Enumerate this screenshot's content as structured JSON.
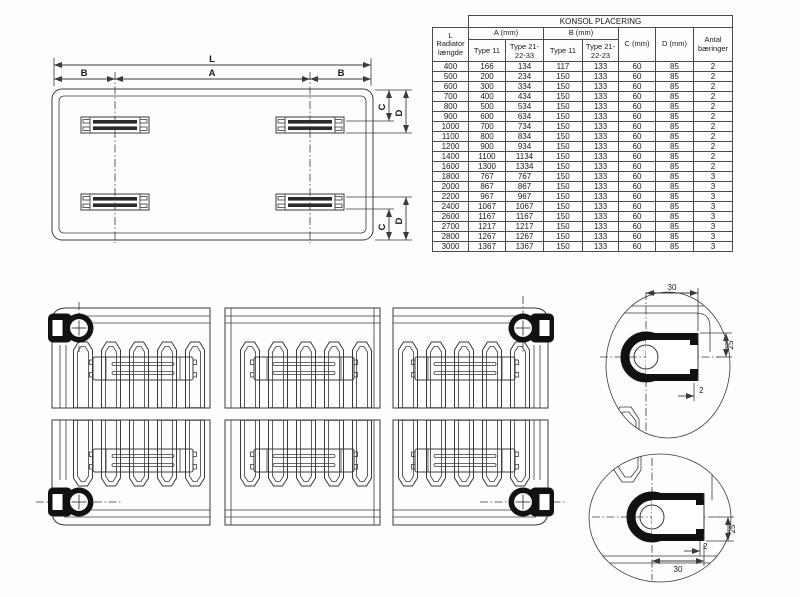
{
  "table": {
    "title": "KONSOL PLACERING",
    "l_header": "L\nRadiator\nlængde",
    "group_a": "A (mm)",
    "group_b": "B (mm)",
    "sub_a_type11": "Type 11",
    "sub_a_type21": "Type 21-22-33",
    "sub_b_type11": "Type 11",
    "sub_b_type21": "Type 21-22-23",
    "col_c": "C (mm)",
    "col_d": "D (mm)",
    "col_antal": "Antal bæringer",
    "rows": [
      [
        "400",
        "166",
        "134",
        "117",
        "133",
        "60",
        "85",
        "2"
      ],
      [
        "500",
        "200",
        "234",
        "150",
        "133",
        "60",
        "85",
        "2"
      ],
      [
        "600",
        "300",
        "334",
        "150",
        "133",
        "60",
        "85",
        "2"
      ],
      [
        "700",
        "400",
        "434",
        "150",
        "133",
        "60",
        "85",
        "2"
      ],
      [
        "800",
        "500",
        "534",
        "150",
        "133",
        "60",
        "85",
        "2"
      ],
      [
        "900",
        "600",
        "634",
        "150",
        "133",
        "60",
        "85",
        "2"
      ],
      [
        "1000",
        "700",
        "734",
        "150",
        "133",
        "60",
        "85",
        "2"
      ],
      [
        "1100",
        "800",
        "834",
        "150",
        "133",
        "60",
        "85",
        "2"
      ],
      [
        "1200",
        "900",
        "934",
        "150",
        "133",
        "60",
        "85",
        "2"
      ],
      [
        "1400",
        "1100",
        "1134",
        "150",
        "133",
        "60",
        "85",
        "2"
      ],
      [
        "1600",
        "1300",
        "1334",
        "150",
        "133",
        "60",
        "85",
        "2"
      ],
      [
        "1800",
        "767",
        "767",
        "150",
        "133",
        "60",
        "85",
        "3"
      ],
      [
        "2000",
        "867",
        "867",
        "150",
        "133",
        "60",
        "85",
        "3"
      ],
      [
        "2200",
        "967",
        "967",
        "150",
        "133",
        "60",
        "85",
        "3"
      ],
      [
        "2400",
        "1067",
        "1067",
        "150",
        "133",
        "60",
        "85",
        "3"
      ],
      [
        "2600",
        "1167",
        "1167",
        "150",
        "133",
        "60",
        "85",
        "3"
      ],
      [
        "2700",
        "1217",
        "1217",
        "150",
        "133",
        "60",
        "85",
        "3"
      ],
      [
        "2800",
        "1267",
        "1267",
        "150",
        "133",
        "60",
        "85",
        "3"
      ],
      [
        "3000",
        "1367",
        "1367",
        "150",
        "133",
        "60",
        "85",
        "3"
      ]
    ]
  },
  "plan_view": {
    "dim_l": "L",
    "dim_a": "A",
    "dim_b_left": "B",
    "dim_b_right": "B",
    "dim_c_top": "C",
    "dim_d_top": "D",
    "dim_c_bottom": "C",
    "dim_d_bottom": "D"
  },
  "detail_top": {
    "dim_30": "30",
    "dim_25": "25",
    "dim_2": "2"
  },
  "detail_bottom": {
    "dim_30": "30",
    "dim_25": "25",
    "dim_2": "2"
  },
  "colors": {
    "line": "#3a3a3a",
    "ink": "#1a1a1a",
    "fill_dark": "#111111",
    "background": "#fdfdfd"
  }
}
